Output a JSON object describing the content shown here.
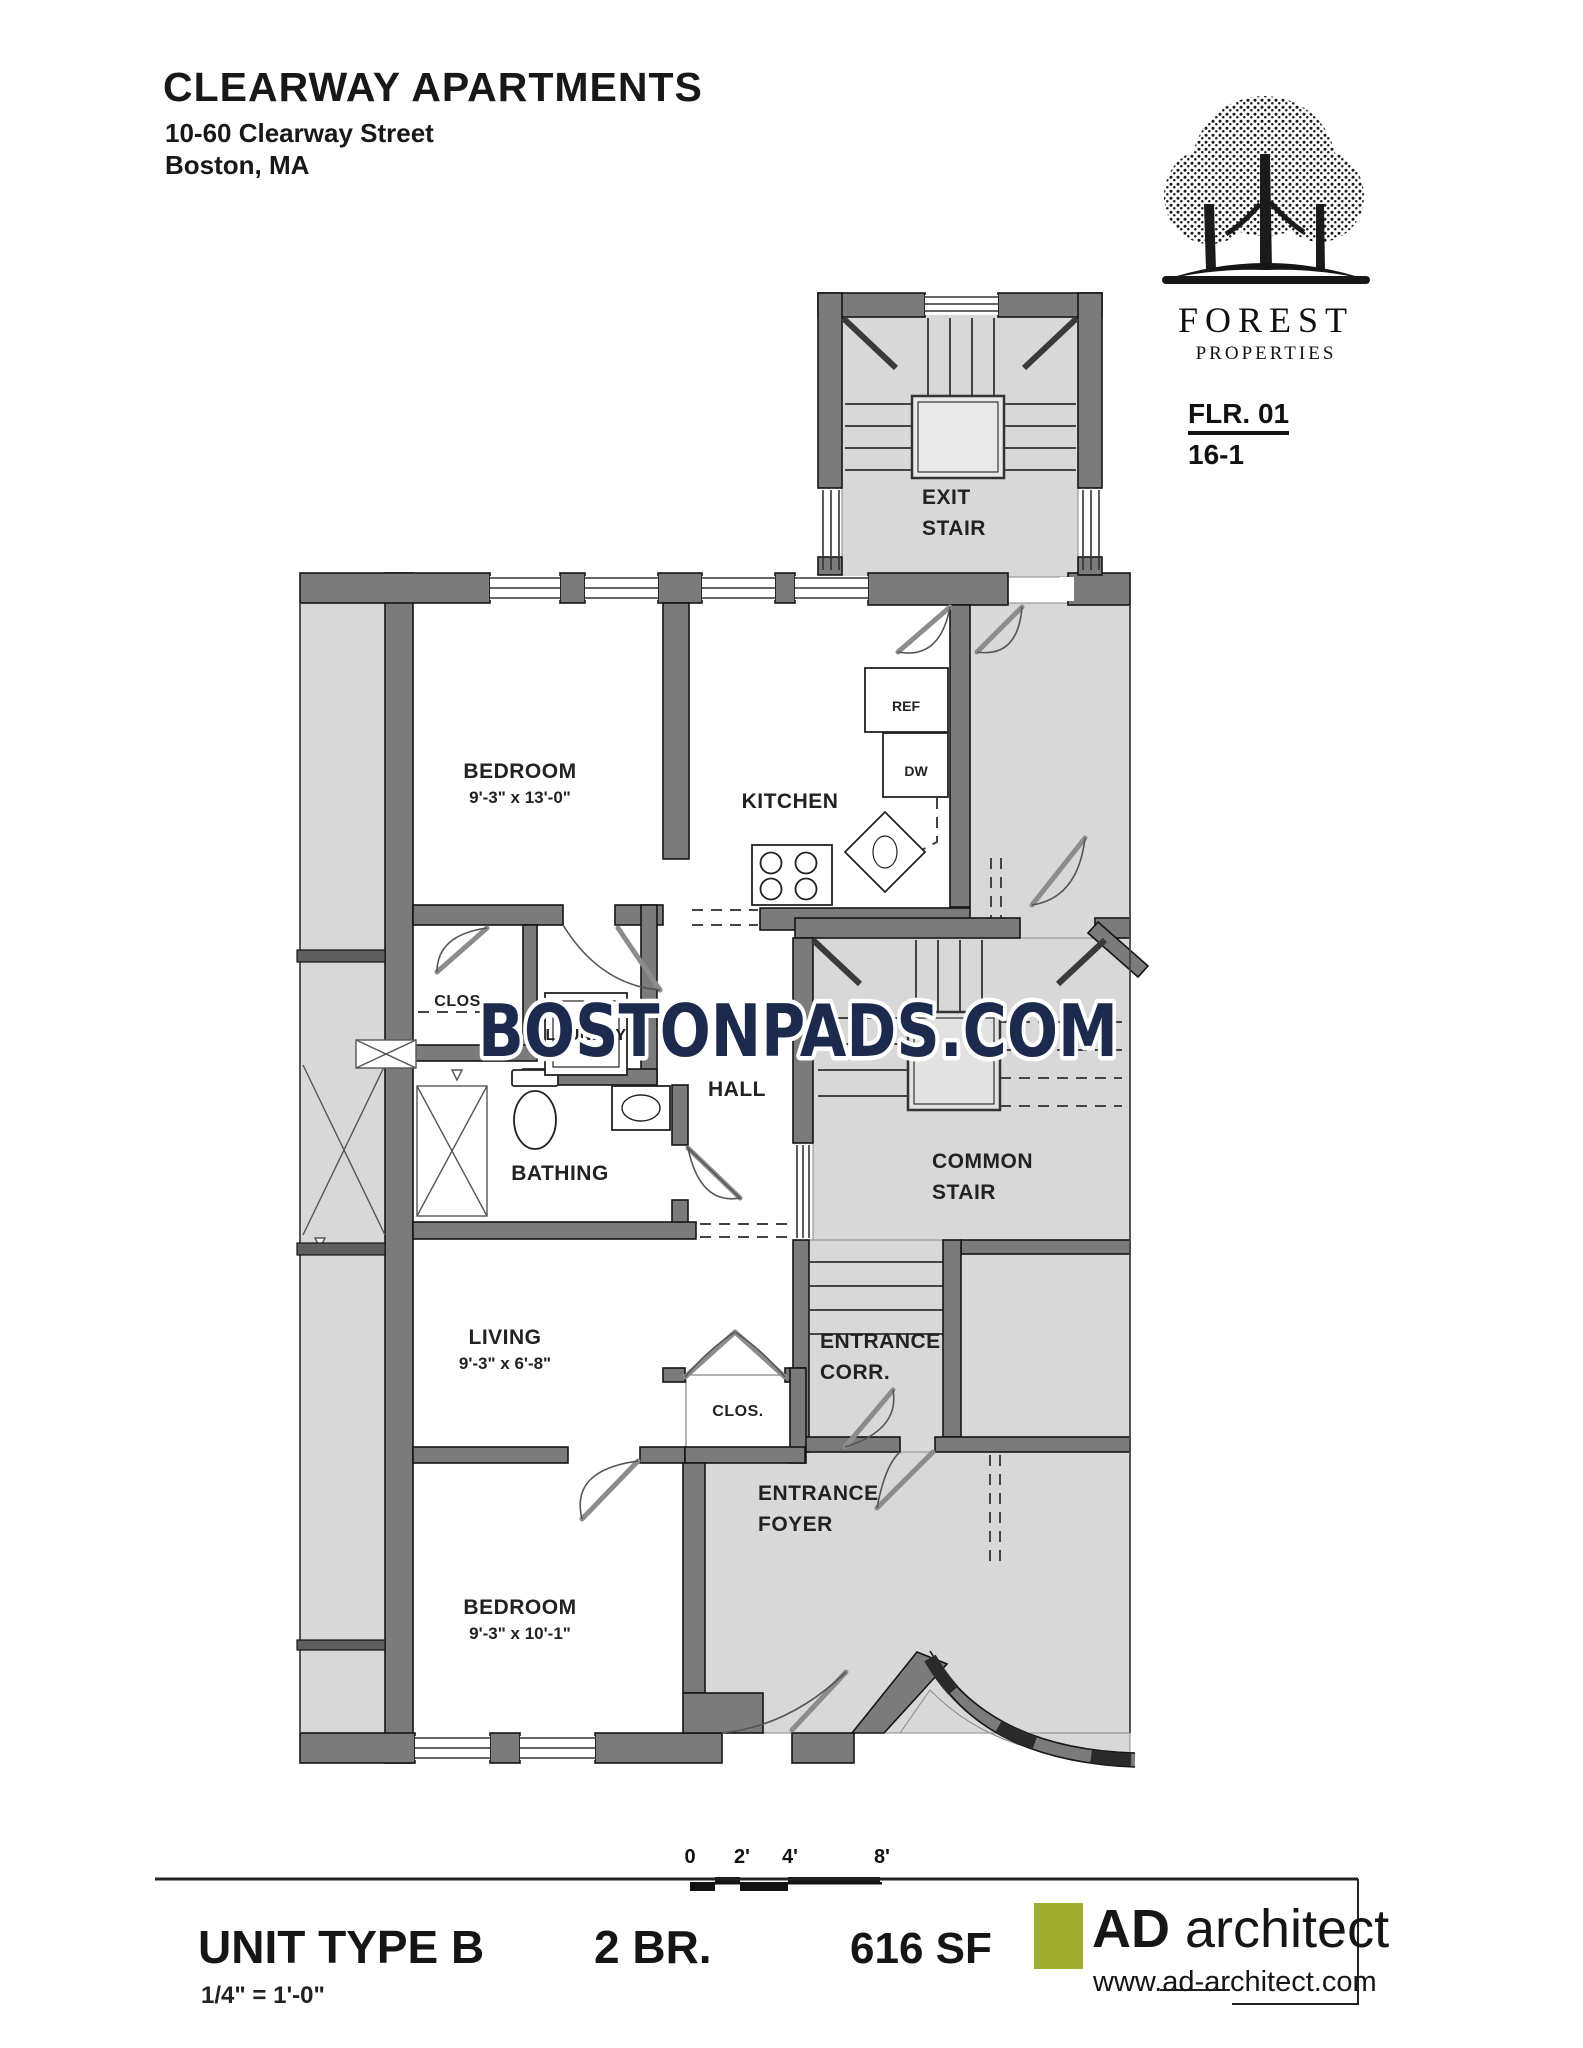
{
  "header": {
    "title": "CLEARWAY APARTMENTS",
    "address_line1": "10-60 Clearway Street",
    "address_line2": "Boston, MA"
  },
  "logo": {
    "company": "FOREST",
    "company_sub": "PROPERTIES",
    "floor_label": "FLR. 01",
    "sheet_number": "16-1"
  },
  "watermark": {
    "text": "BOSTONPADS.COM",
    "color": "#1c2b4d"
  },
  "rooms": {
    "exit_stair": {
      "line1": "EXIT",
      "line2": "STAIR"
    },
    "bedroom_top": {
      "label": "BEDROOM",
      "dims": "9'-3\" x 13'-0\""
    },
    "kitchen": {
      "label": "KITCHEN"
    },
    "closet_top": {
      "label": "CLOS."
    },
    "laundry": {
      "label": "LAUNDRY"
    },
    "hall": {
      "label": "HALL"
    },
    "bathing": {
      "label": "BATHING"
    },
    "common_stair": {
      "line1": "COMMON",
      "line2": "STAIR"
    },
    "living": {
      "label": "LIVING",
      "dims": "9'-3\" x 6'-8\""
    },
    "closet_living": {
      "label": "CLOS."
    },
    "entrance_corr": {
      "line1": "ENTRANCE",
      "line2": "CORR."
    },
    "entrance_foyer": {
      "line1": "ENTRANCE",
      "line2": "FOYER"
    },
    "bedroom_bottom": {
      "label": "BEDROOM",
      "dims": "9'-3\" x 10'-1\""
    }
  },
  "fixtures": {
    "fridge": "REF",
    "dishwasher": "DW"
  },
  "scale_bar": {
    "tick0": "0",
    "tick2": "2'",
    "tick4": "4'",
    "tick8": "8'"
  },
  "footer": {
    "unit_type": "UNIT TYPE B",
    "scale_note": "1/4\" = 1'-0\"",
    "bedroom_count": "2 BR.",
    "area": "616 SF",
    "architect_bold": "AD",
    "architect_light": " architect",
    "architect_url": "www.ad-architect.com",
    "accent_color": "#9fae2c",
    "wall_color": "#7b7b7b",
    "common_area_color": "#d8d8d8"
  }
}
